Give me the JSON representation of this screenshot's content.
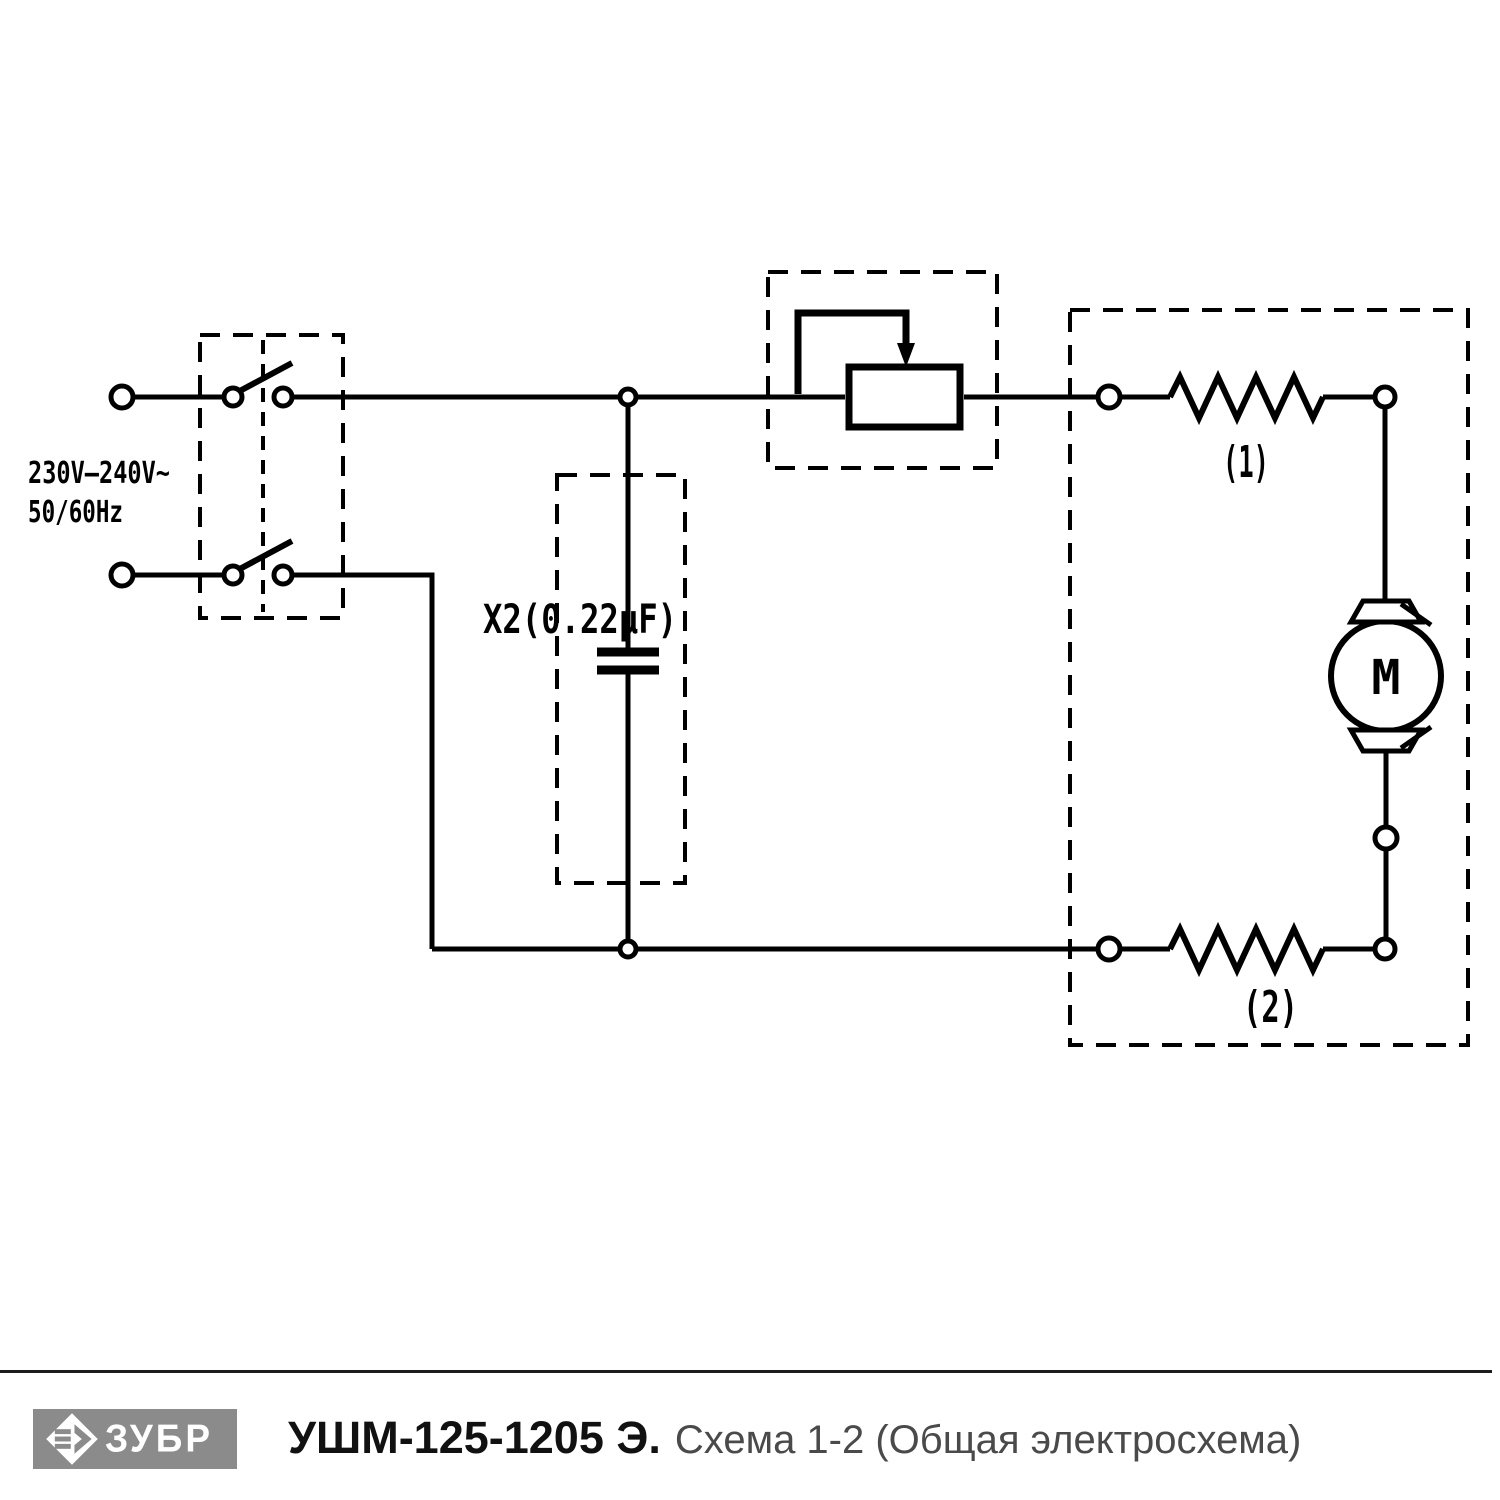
{
  "page": {
    "background_color": "#ffffff",
    "line_color": "#000000"
  },
  "schematic": {
    "power_label_line1": "230V–240V~",
    "power_label_line2": "50/60Hz",
    "capacitor_label": "X2(0.22µF)",
    "field_winding_1_label": "(1)",
    "field_winding_2_label": "(2)",
    "motor_label": "M"
  },
  "footer": {
    "brand_name": "ЗУБР",
    "logo_background_color": "#8b8b8b",
    "model_title": "УШМ-125-1205 Э.",
    "schematic_subtitle": "Схема 1-2 (Общая электросхема)"
  }
}
